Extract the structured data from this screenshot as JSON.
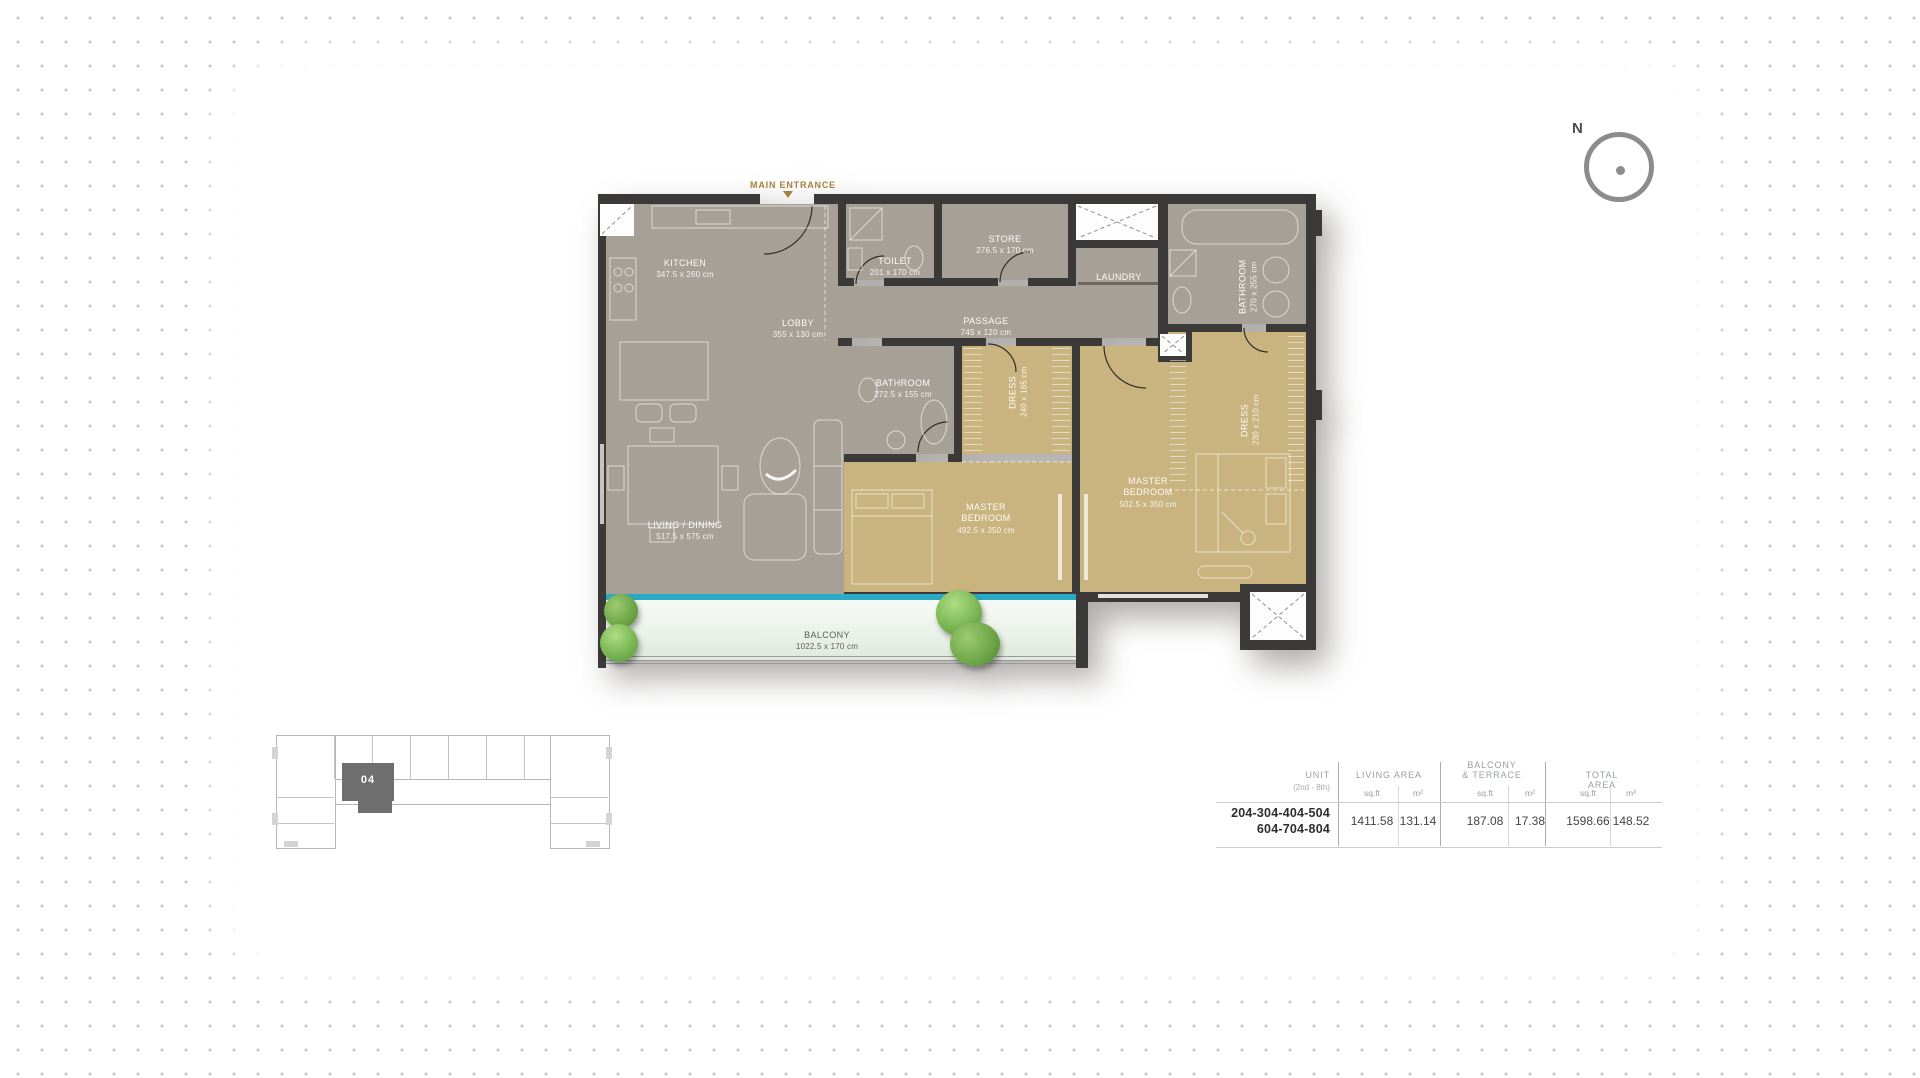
{
  "compass": {
    "label": "N"
  },
  "plan": {
    "entrance_label": "MAIN ENTRANCE",
    "rooms": [
      {
        "id": "kitchen",
        "name": "KITCHEN",
        "dims": "347.5 x 260 cm"
      },
      {
        "id": "lobby",
        "name": "LOBBY",
        "dims": "355 x 130 cm"
      },
      {
        "id": "toilet",
        "name": "TOILET",
        "dims": "201 x 170 cm"
      },
      {
        "id": "store",
        "name": "STORE",
        "dims": "276.5 x 170 cm"
      },
      {
        "id": "laundry",
        "name": "LAUNDRY",
        "dims": ""
      },
      {
        "id": "passage",
        "name": "PASSAGE",
        "dims": "745 x 120 cm"
      },
      {
        "id": "bathroom-right",
        "name": "BATHROOM",
        "dims": "270 x 255 cm"
      },
      {
        "id": "dress-right",
        "name": "DRESS",
        "dims": "230 x 210 cm"
      },
      {
        "id": "bathroom-mid",
        "name": "BATHROOM",
        "dims": "272.5 x 155 cm"
      },
      {
        "id": "dress-mid",
        "name": "DRESS",
        "dims": "240 x 165 cm"
      },
      {
        "id": "living",
        "name": "LIVING / DINING",
        "dims": "517.5 x 575 cm"
      },
      {
        "id": "master-bedroom-1",
        "name": "MASTER\nBEDROOM",
        "dims": "492.5 x 350 cm"
      },
      {
        "id": "master-bedroom-2",
        "name": "MASTER\nBEDROOM",
        "dims": "502.5 x 350 cm"
      },
      {
        "id": "balcony",
        "name": "BALCONY",
        "dims": "1022.5 x 170 cm"
      }
    ]
  },
  "keyplan": {
    "unit_label": "04"
  },
  "area_table": {
    "unit_header": "UNIT",
    "unit_subheader": "(2nd - 8th)",
    "groups": [
      {
        "title": "LIVING AREA",
        "sqft_label": "sq.ft",
        "m2_label": "m²"
      },
      {
        "title": "BALCONY\n& TERRACE",
        "sqft_label": "sq.ft",
        "m2_label": "m²"
      },
      {
        "title": "TOTAL AREA",
        "sqft_label": "sq.ft",
        "m2_label": "m²"
      }
    ],
    "row": {
      "units": [
        "204-304-404-504",
        "604-704-804"
      ],
      "values": [
        "1411.58",
        "131.14",
        "187.08",
        "17.38",
        "1598.66",
        "148.52"
      ]
    }
  },
  "colors": {
    "wall": "#3b3a38",
    "floor_gray": "#a7a096",
    "floor_tan": "#c9b37e",
    "glass": "#2baac5",
    "entrance_gold": "#a4823f"
  }
}
